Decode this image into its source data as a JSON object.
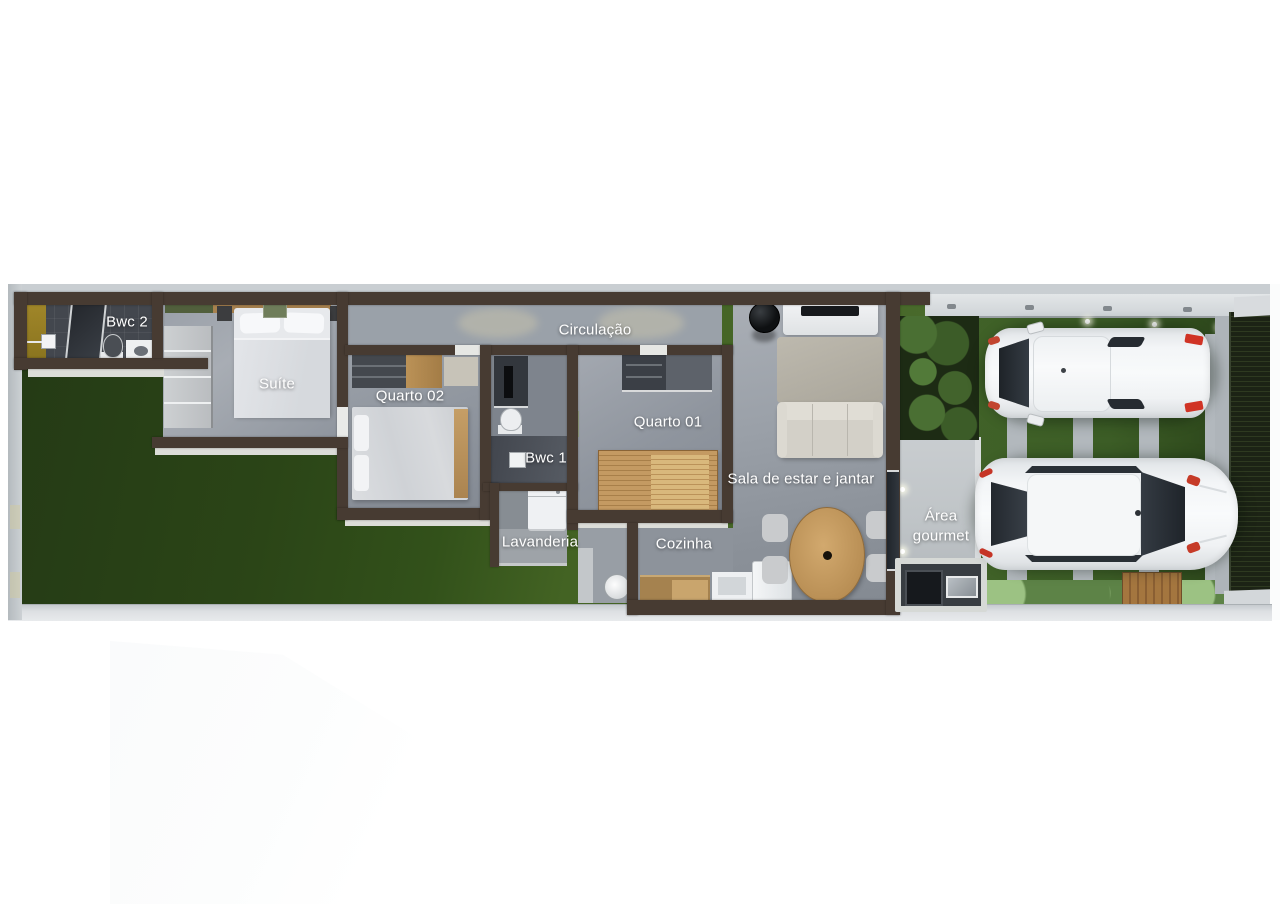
{
  "labels": {
    "bwc2": "Bwc 2",
    "suite": "Suíte",
    "quarto02": "Quarto 02",
    "bwc1": "Bwc 1",
    "circulacao": "Circulação",
    "quarto01": "Quarto 01",
    "lavanderia": "Lavanderia",
    "cozinha": "Cozinha",
    "sala": "Sala de estar e jantar",
    "area_gourmet": "Área gourmet"
  },
  "colors": {
    "wall_brown": "#473b32",
    "floor_gray": "#99a0a8",
    "grass_dark": "#2b4517",
    "grass_light": "#4a6b2d",
    "frontyard_grass": "#3c5d26",
    "boundary_gray": "#cdd2d6",
    "concrete_strip": "#b2b8bd",
    "wood": "#b98f55",
    "car_white": "#f3f5f7",
    "glass_dark": "#23282e",
    "taillight_red": "#c53526",
    "gate_dark": "#1c2315",
    "label_text": "#ffffff"
  }
}
